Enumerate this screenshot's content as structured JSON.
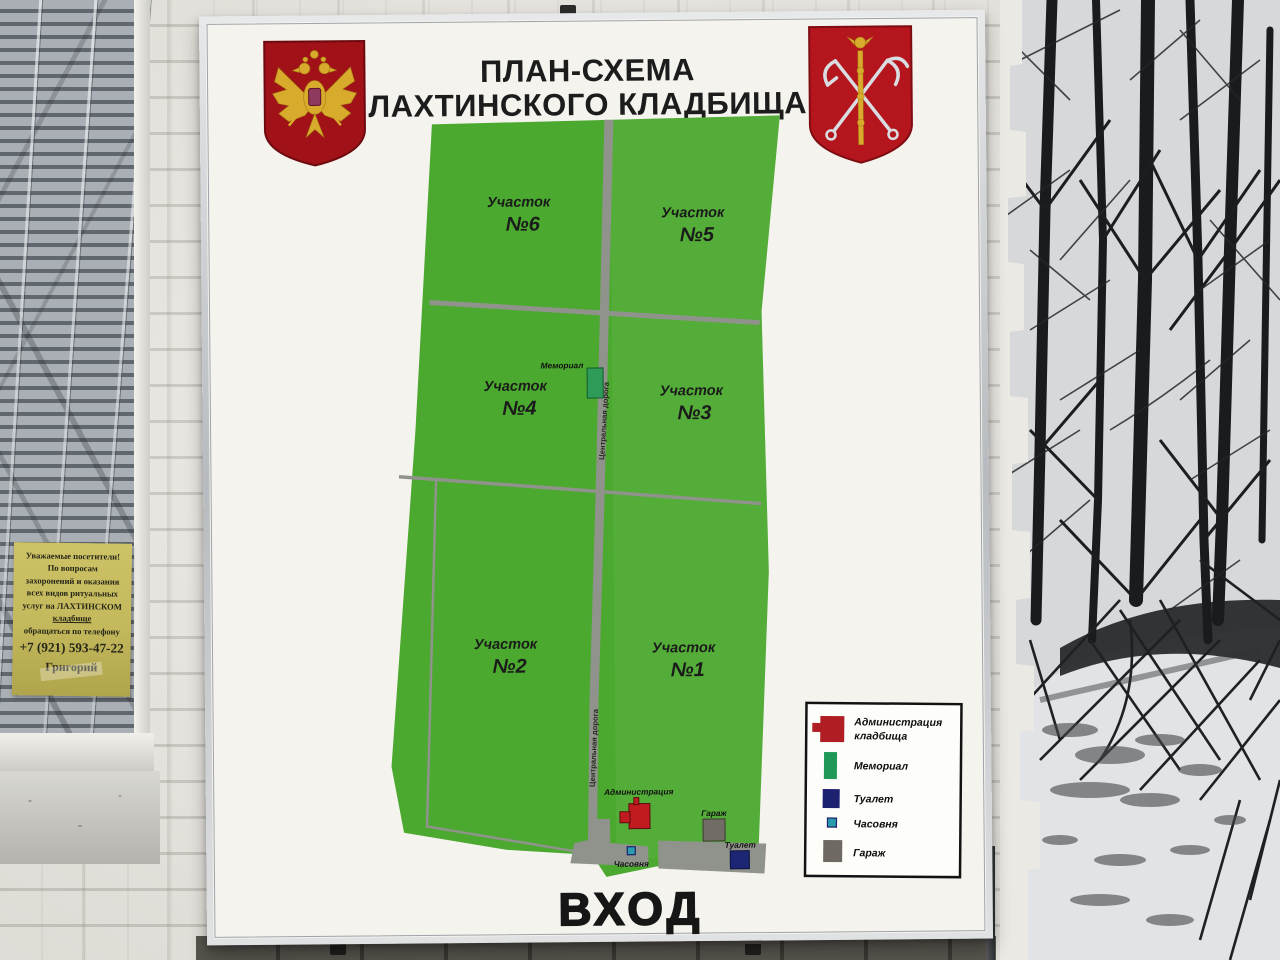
{
  "board": {
    "title": {
      "line1": "ПЛАН-СХЕМА",
      "line2": "ЛАХТИНСКОГО КЛАДБИЩА"
    },
    "entrance": "ВХОД",
    "emblems": {
      "left": "russia-coat-of-arms",
      "right": "saint-petersburg-coat-of-arms"
    }
  },
  "map": {
    "sections": [
      {
        "name": "Участок",
        "number": "№6"
      },
      {
        "name": "Участок",
        "number": "№5"
      },
      {
        "name": "Участок",
        "number": "№4"
      },
      {
        "name": "Участок",
        "number": "№3"
      },
      {
        "name": "Участок",
        "number": "№2"
      },
      {
        "name": "Участок",
        "number": "№1"
      }
    ],
    "road_label": "Центральная дорога",
    "buildings": {
      "memorial": "Мемориал",
      "administration": "Администрация",
      "chapel": "Часовня",
      "garage": "Гараж",
      "toilet": "Туалет"
    }
  },
  "legend": {
    "items": [
      {
        "line1": "Администрация",
        "line2": "кладбища",
        "color": "#b01e23"
      },
      {
        "line1": "Мемориал",
        "color": "#1f9858"
      },
      {
        "line1": "Туалет",
        "color": "#1d2270"
      },
      {
        "line1": "Часовня",
        "color": "#2a9cab"
      },
      {
        "line1": "Гараж",
        "color": "#6e6a63"
      }
    ]
  },
  "notice_sign": {
    "lines": [
      "Уважаемые посетители!",
      "По вопросам",
      "захоронений и оказания",
      "всех видов ритуальных",
      "услуг на ЛАХТИНСКОМ",
      "кладбище",
      "обращаться по телефону"
    ],
    "phone": "+7 (921) 593-47-22",
    "contact": "Григорий"
  },
  "colors": {
    "map_green": "#4aa92e",
    "road_gray": "#90938b",
    "admin_red": "#c01b1f",
    "memorial_green": "#2e9b59",
    "chapel_teal": "#2a9cab",
    "garage_gray": "#716d66",
    "toilet_navy": "#1d2675"
  }
}
